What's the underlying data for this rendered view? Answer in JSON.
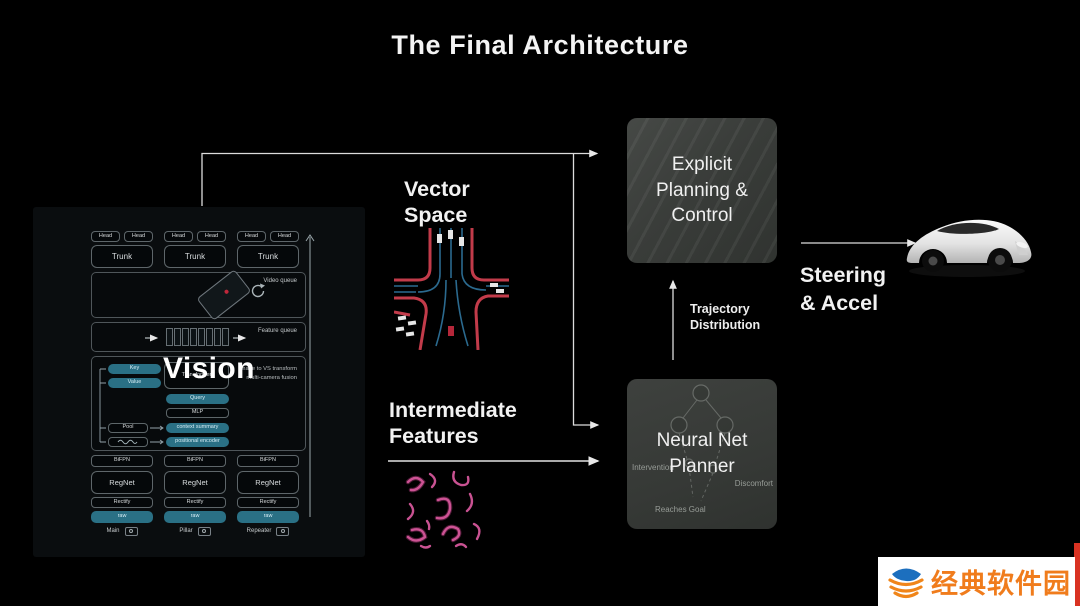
{
  "title": "The Final Architecture",
  "vision": {
    "label": "Vision",
    "heads": [
      "Head",
      "Head",
      "Head",
      "Head",
      "Head",
      "Head"
    ],
    "trunks": [
      "Trunk",
      "Trunk",
      "Trunk"
    ],
    "video_queue_label": "Video queue",
    "feature_queue_label": "Feature queue",
    "fusion": {
      "key": "Key",
      "value": "Value",
      "transformer": "Transformer",
      "query": "Query",
      "mlp": "MLP",
      "pool": "Pool",
      "context_summary": "context summary",
      "positional_encoder": "positional encoder",
      "note": "Image to VS transform\nmulti-camera fusion"
    },
    "columns": [
      {
        "bifpn": "BiFPN",
        "regnet": "RegNet",
        "rectify": "Rectify",
        "raw": "raw",
        "camera": "Main"
      },
      {
        "bifpn": "BiFPN",
        "regnet": "RegNet",
        "rectify": "Rectify",
        "raw": "raw",
        "camera": "Pillar"
      },
      {
        "bifpn": "BiFPN",
        "regnet": "RegNet",
        "rectify": "Rectify",
        "raw": "raw",
        "camera": "Repeater"
      }
    ]
  },
  "flow": {
    "vector_space": "Vector\nSpace",
    "intermediate_features": "Intermediate\nFeatures",
    "trajectory_distribution": "Trajectory\nDistribution",
    "steering_accel": "Steering\n& Accel"
  },
  "planning": {
    "explicit_box": "Explicit\nPlanning &\nControl",
    "planner_box": "Neural Net\nPlanner",
    "planner_faint_left": "Intervention",
    "planner_faint_right": "Discomfort",
    "planner_faint_bottom": "Reaches Goal"
  },
  "watermark": {
    "site_name": "经典软件园"
  },
  "colors": {
    "background": "#000000",
    "teal_box": "#2a7085",
    "curb_red": "#c23b4a",
    "lane_blue": "#2b6a8f",
    "feature_pink": "#d4579a",
    "watermark_orange": "#f07c1c",
    "watermark_blue": "#1c6fbe",
    "watermark_red_strip": "#d93222"
  }
}
